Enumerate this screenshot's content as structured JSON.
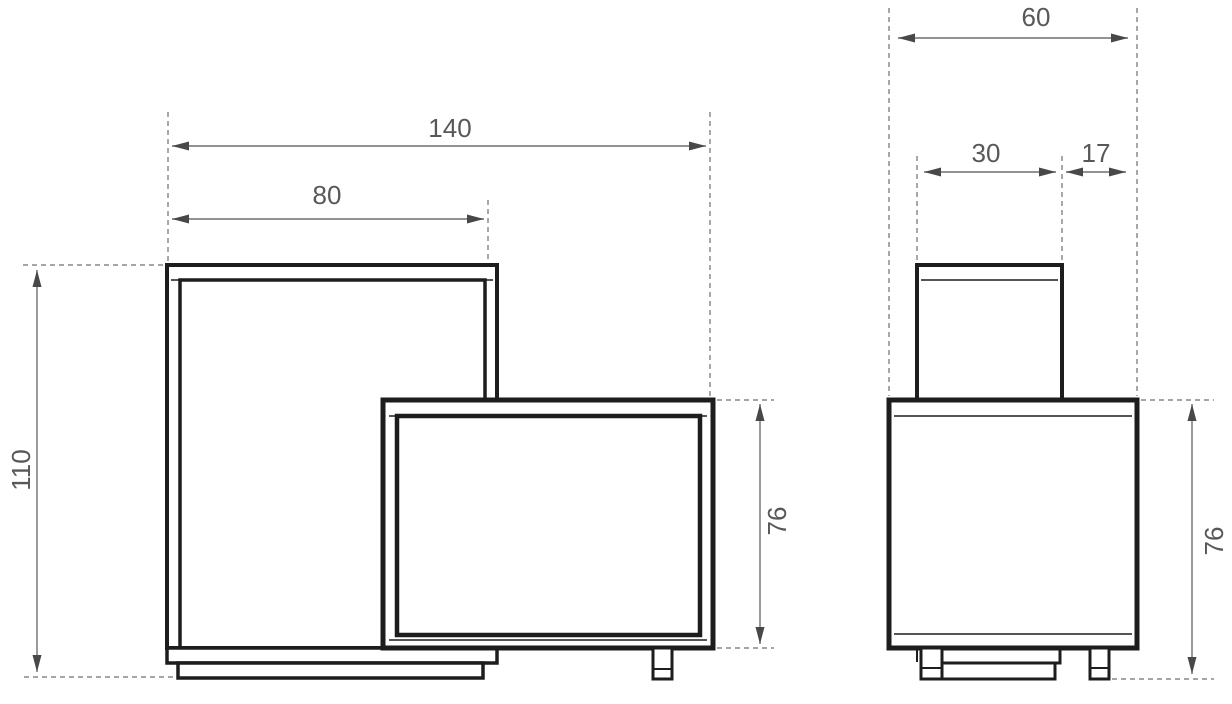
{
  "colors": {
    "outline": "#1d1d1f",
    "dimension_line": "#6f6f71",
    "dimension_text": "#58585a",
    "arrowhead": "#48484a",
    "background": "#ffffff"
  },
  "front_view": {
    "dimensions": {
      "total_width": "140",
      "tall_section_width": "80",
      "total_height": "110",
      "lower_section_height": "76"
    }
  },
  "side_view": {
    "dimensions": {
      "total_depth": "60",
      "upper_section_depth": "30",
      "front_overhang_depth": "17",
      "lower_section_height": "76"
    }
  }
}
